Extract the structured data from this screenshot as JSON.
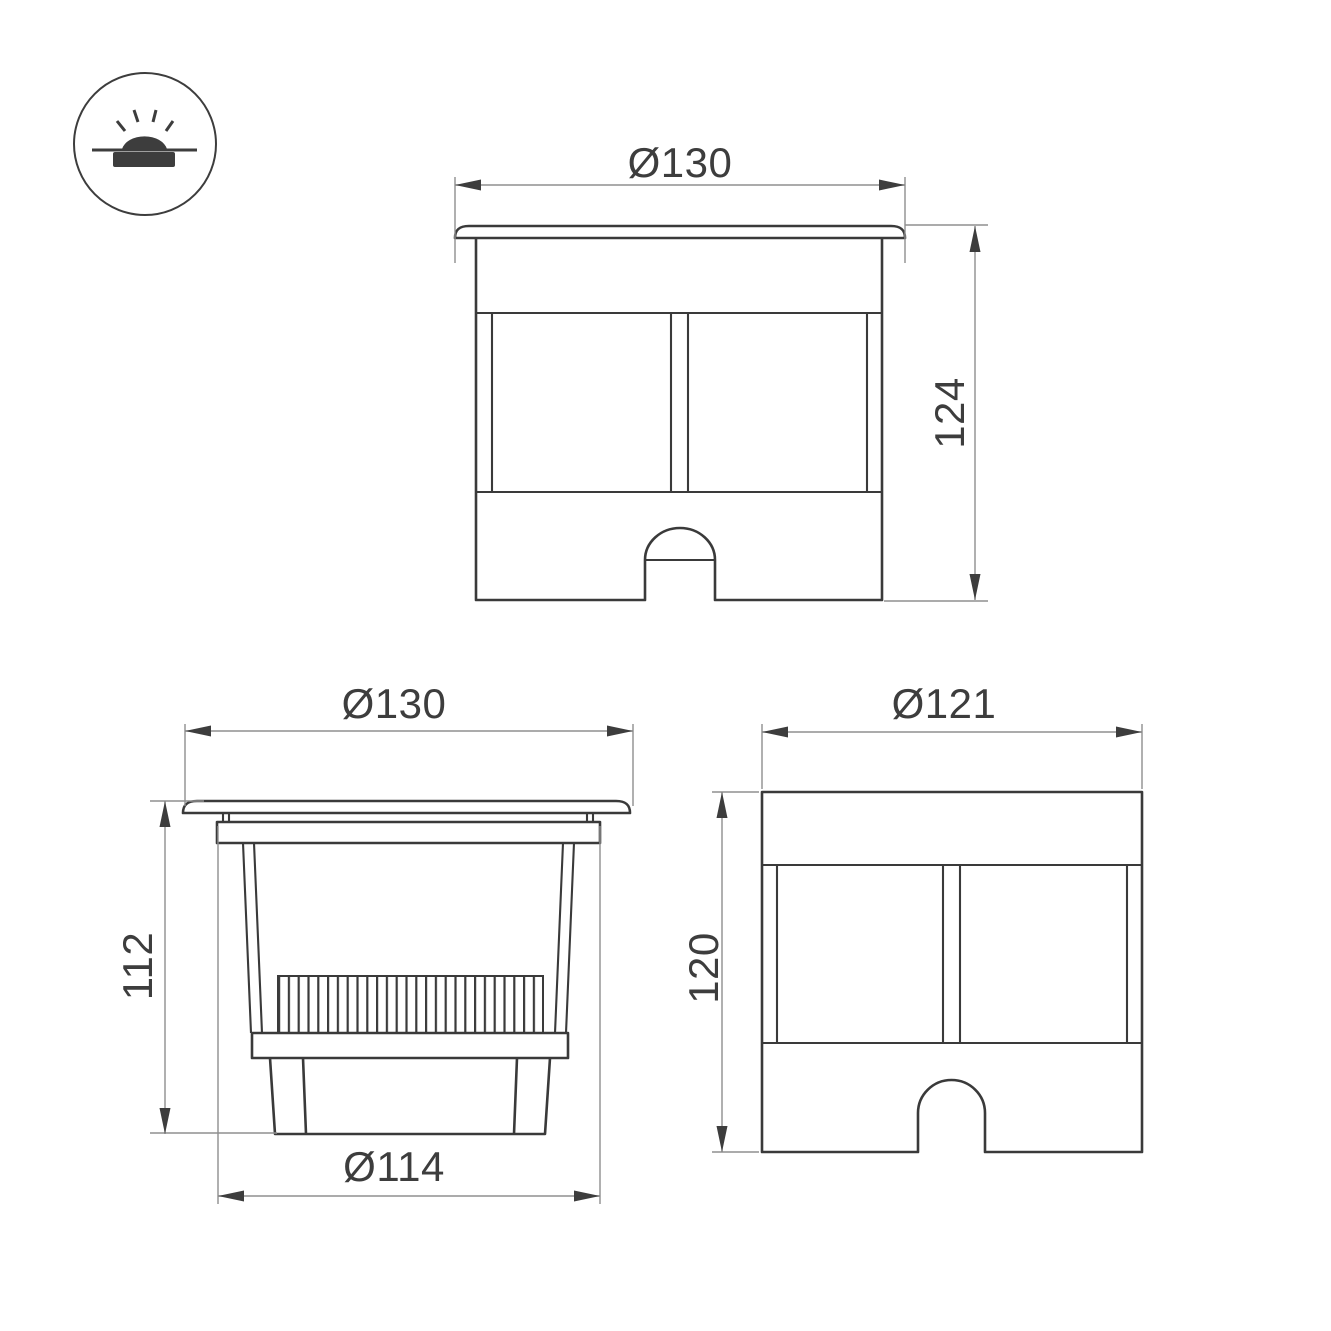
{
  "icon": {
    "name": "recessed-in-ground-luminaire-symbol"
  },
  "views": {
    "front": {
      "width_label": "Ø130",
      "height_label": "124"
    },
    "section": {
      "width_label": "Ø130",
      "height_label": "112",
      "base_label": "Ø114"
    },
    "side": {
      "width_label": "Ø121",
      "height_label": "120"
    }
  },
  "colors": {
    "outline": "#3a3a3a",
    "dimension_line": "#8f8f8f",
    "text": "#3d3d3d",
    "background": "#ffffff"
  }
}
